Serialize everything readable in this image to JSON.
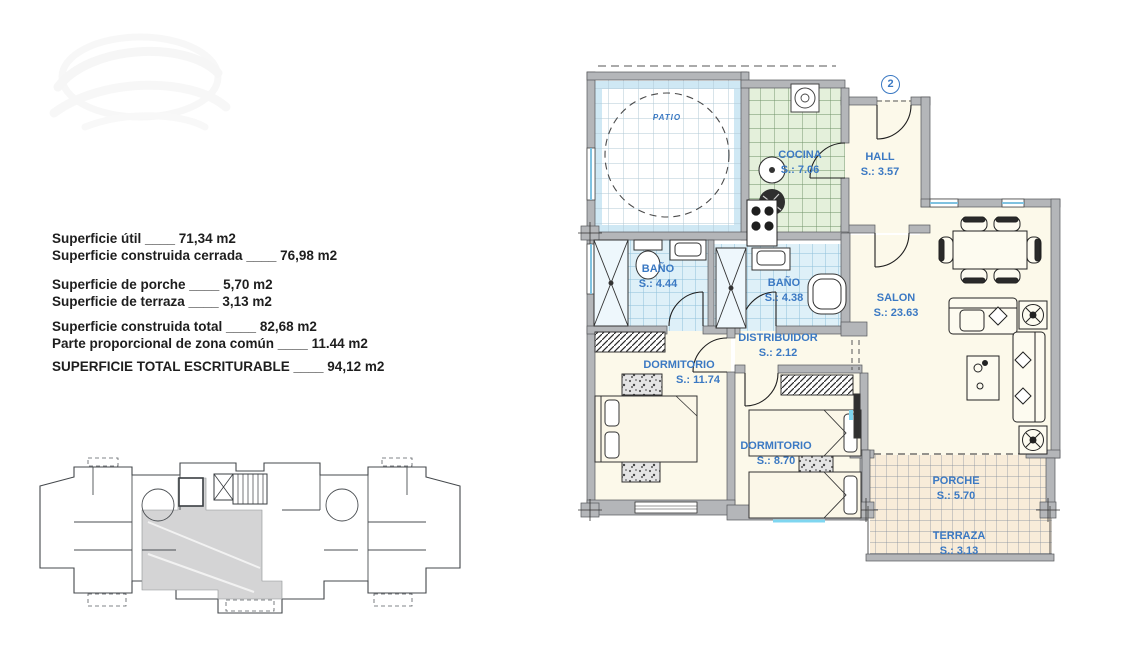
{
  "summary": {
    "lines": {
      "l0": "Superficie útil ____ 71,34 m2",
      "l1": "Superficie construida cerrada ____ 76,98 m2",
      "l2": "Superficie de porche ____ 5,70 m2",
      "l3": "Superficie de terraza ____ 3,13 m2",
      "l4": "Superficie construida total ____ 82,68 m2",
      "l5": "Parte proporcional de zona común ____ 11.44 m2",
      "l6": "SUPERFICIE TOTAL ESCRITURABLE ____ 94,12 m2"
    }
  },
  "plan": {
    "badge": "2",
    "rooms": {
      "patio": {
        "name": "PATIO"
      },
      "cocina": {
        "name": "COCINA",
        "area": "S.: 7.06"
      },
      "hall": {
        "name": "HALL",
        "area": "S.: 3.57"
      },
      "bano1": {
        "name": "BAÑO",
        "area": "S.: 4.44"
      },
      "bano2": {
        "name": "BAÑO",
        "area": "S.: 4.38"
      },
      "distribuidor": {
        "name": "DISTRIBUIDOR",
        "area": "S.: 2.12"
      },
      "dormitorio1": {
        "name": "DORMITORIO",
        "area": "S.: 11.74"
      },
      "dormitorio2": {
        "name": "DORMITORIO",
        "area": "S.: 8.70"
      },
      "salon": {
        "name": "SALON",
        "area": "S.: 23.63"
      },
      "porche": {
        "name": "PORCHE",
        "area": "S.: 5.70"
      },
      "terraza": {
        "name": "TERRAZA",
        "area": "S.: 3.13"
      }
    },
    "colors": {
      "label_blue": "#3b79c3",
      "wall_gray": "#b4b6b9",
      "tile_blue": "#def0f8",
      "tile_green": "#e4f0db",
      "tile_tan": "#f8ecd9",
      "room_cream": "#fcf9ea"
    }
  }
}
